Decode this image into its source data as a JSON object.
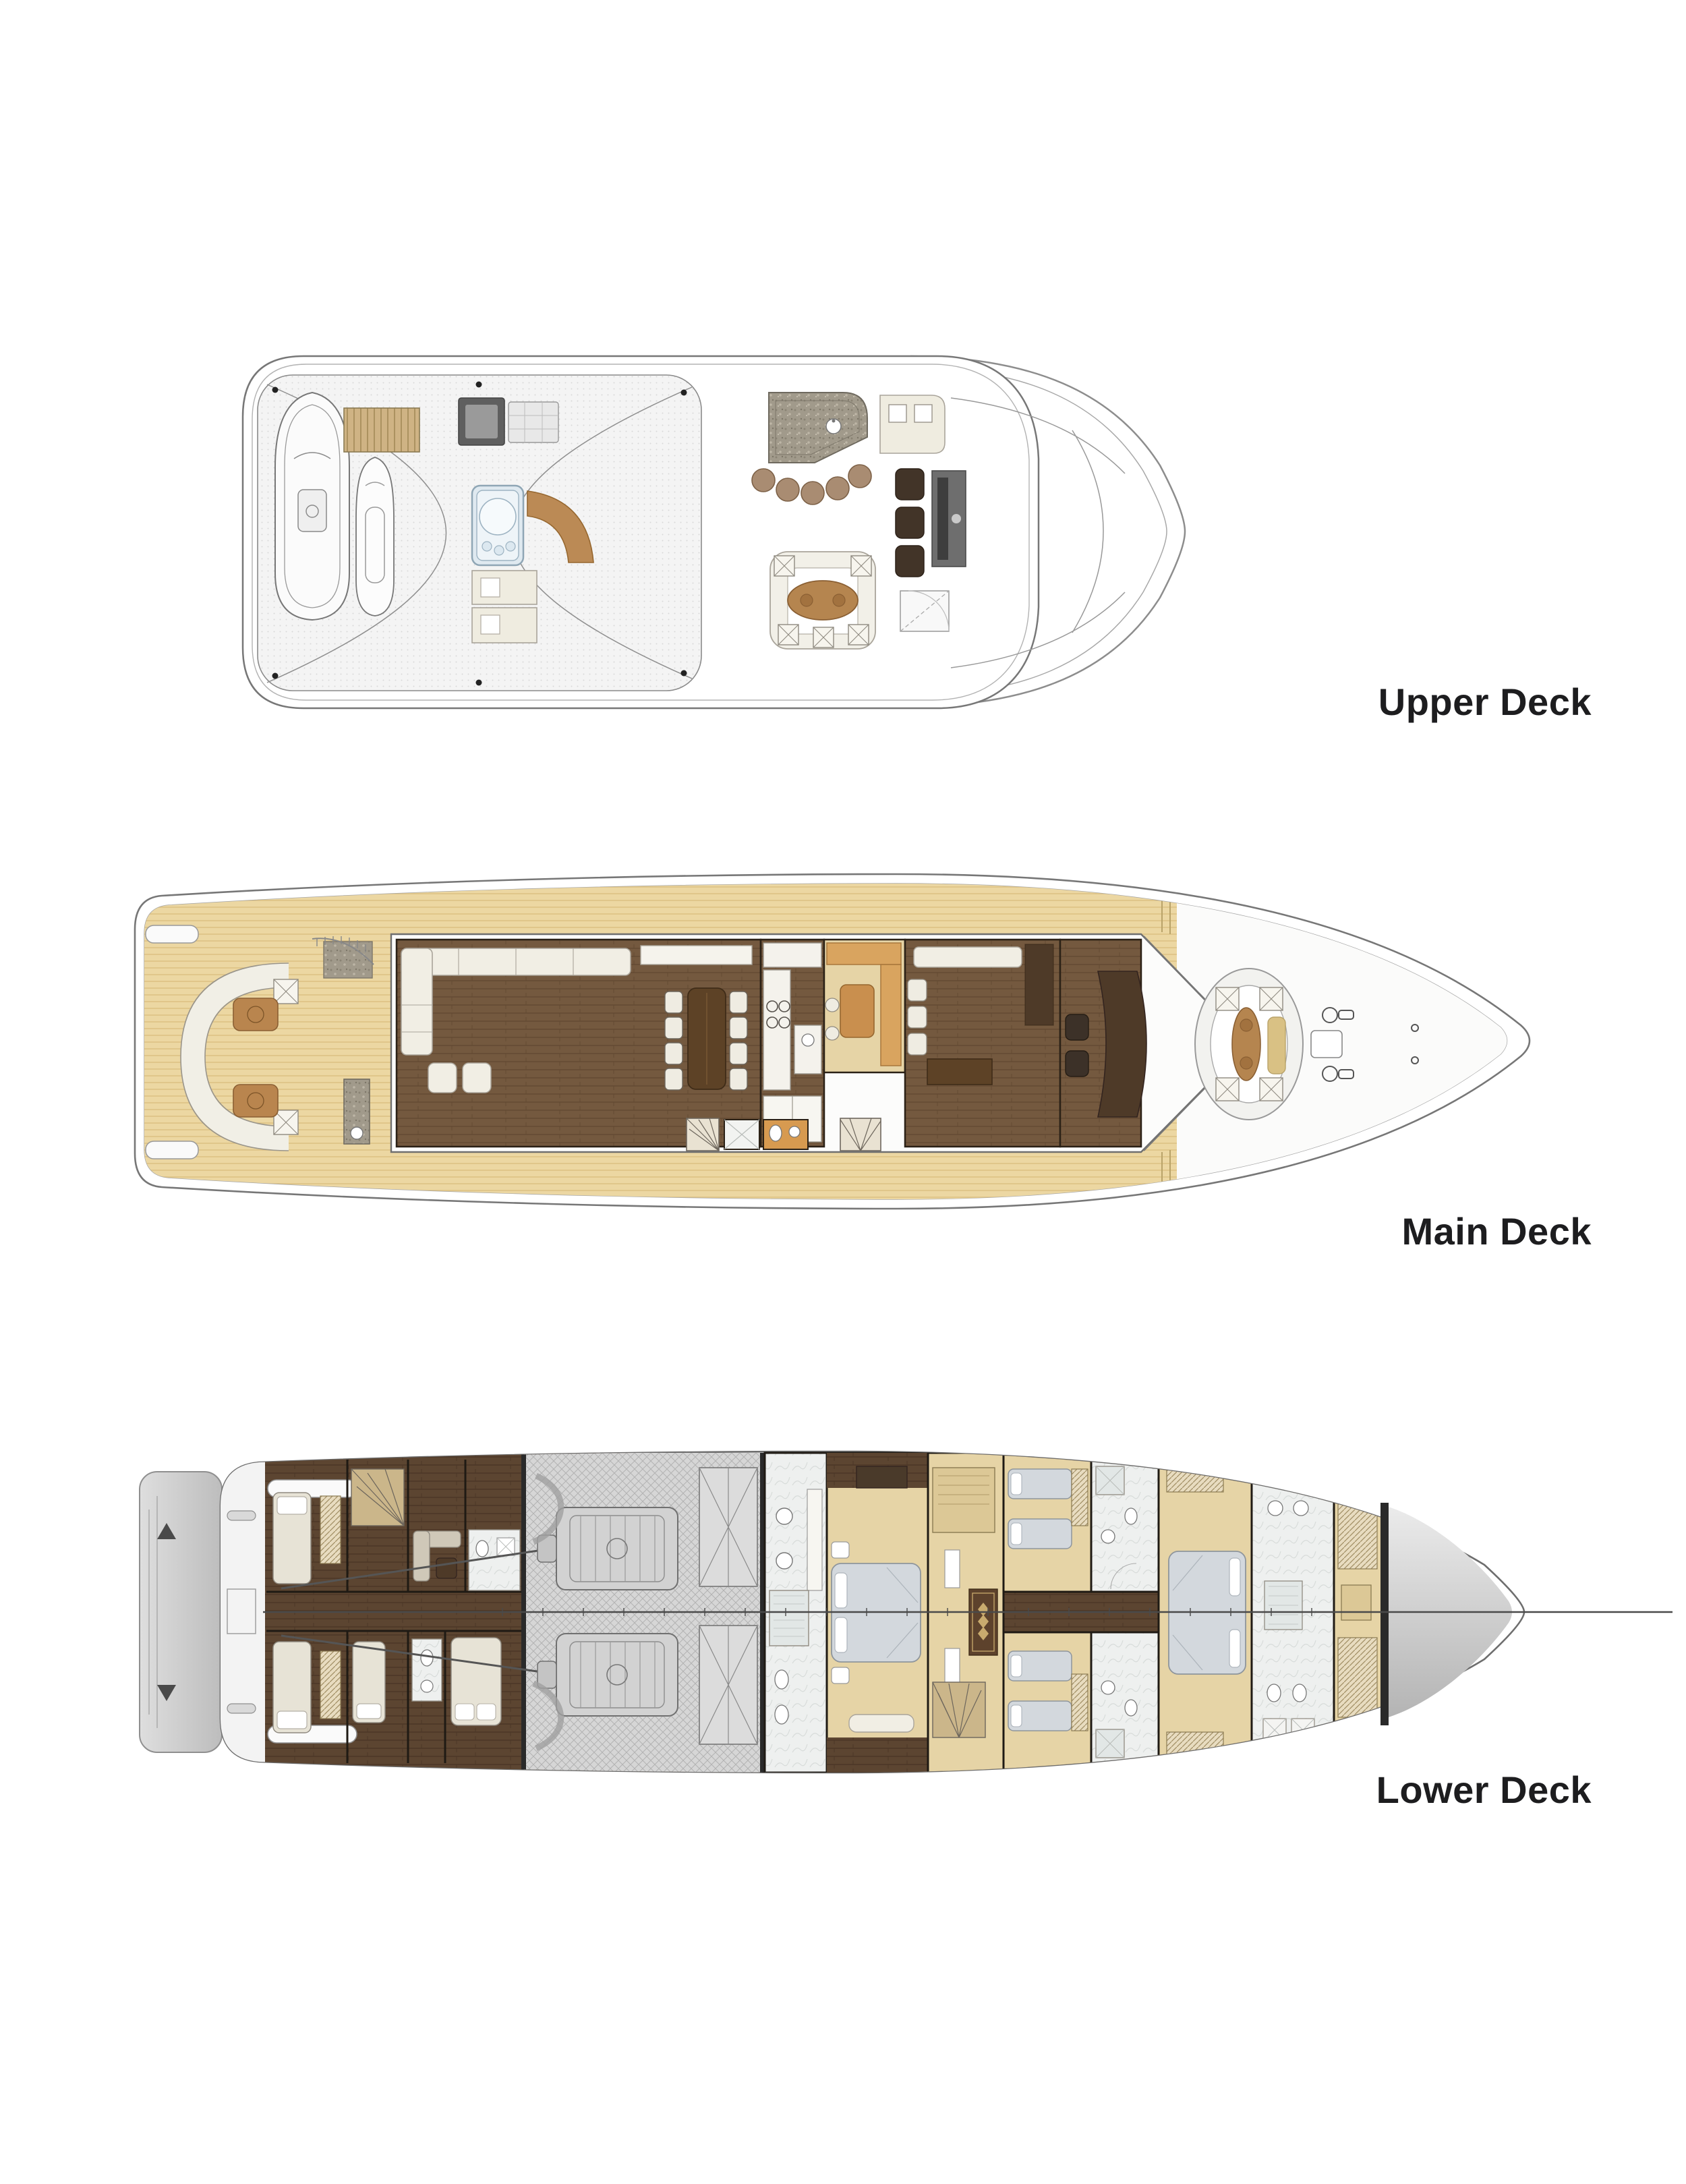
{
  "page": {
    "background_color": "#ffffff",
    "label_color": "#1d1d1f"
  },
  "decks": [
    {
      "id": "upper-deck",
      "label": "Upper Deck"
    },
    {
      "id": "main-deck",
      "label": "Main Deck"
    },
    {
      "id": "lower-deck",
      "label": "Lower Deck"
    }
  ],
  "palette": {
    "hull_line": "#777777",
    "inner_line": "#9a9a9a",
    "teak_deck": "#ecd7a2",
    "teak_stripe": "#dcc083",
    "salon_wood": "#74593f",
    "lower_wood": "#5c4531",
    "cream_furniture": "#f1eee4",
    "furniture_trim": "#a9a49a",
    "dark_table_wood": "#5d4226",
    "brown_table": "#b9854e",
    "jacuzzi_blue": "#dfe9f0",
    "granite": "#a19a8b",
    "engine_room_gray": "#d6d6d6",
    "marble_bath": "#eef0ef",
    "carpet_tan": "#e6d4a6",
    "bedding_gray": "#d3d8dd",
    "orange_wood": "#d79a50",
    "dark_chair": "#423428",
    "platform_gray": "#c9c9c9",
    "wall_dark": "#2b2116"
  }
}
